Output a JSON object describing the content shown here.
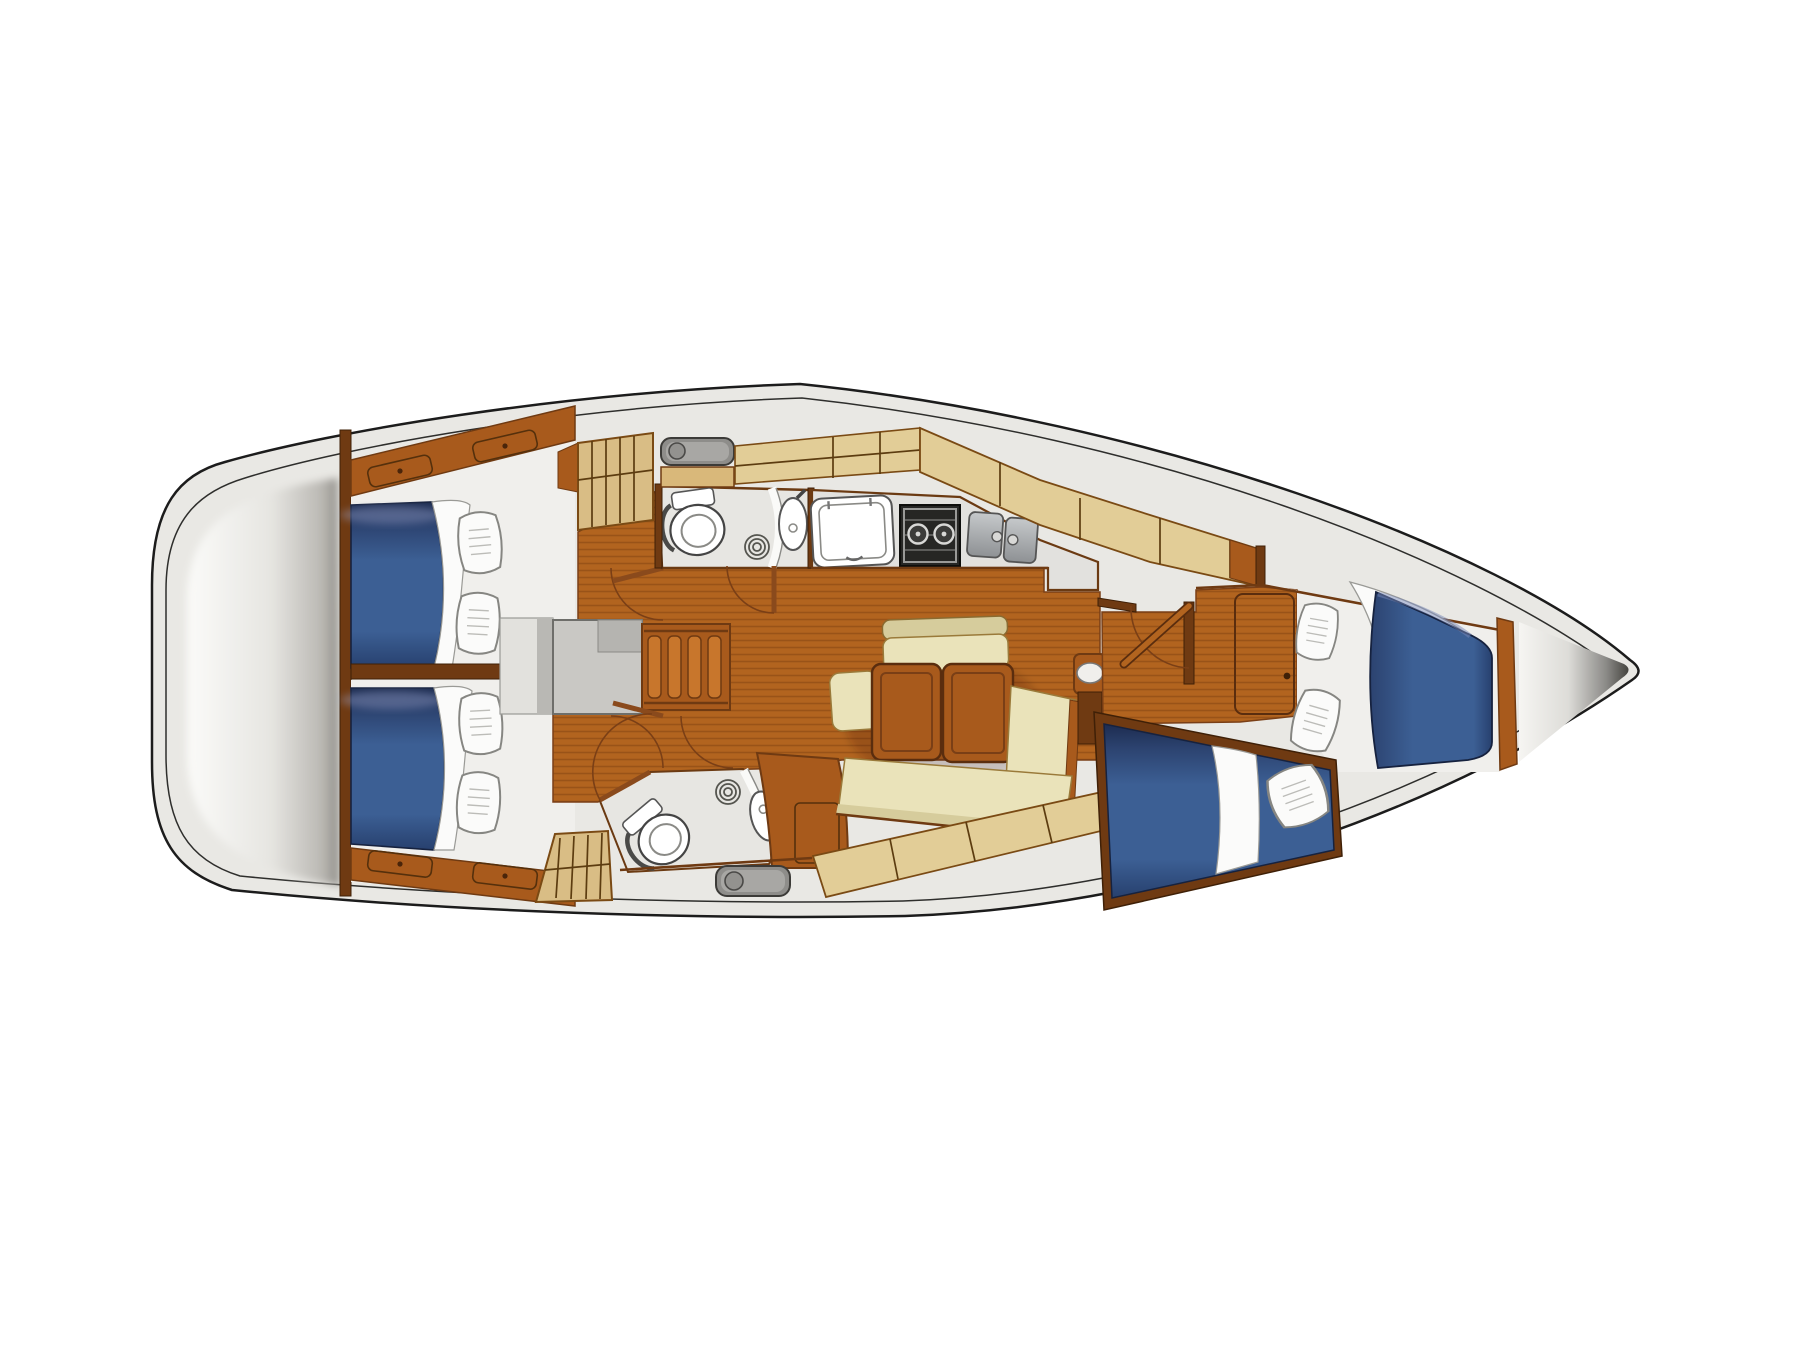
{
  "page": {
    "background": "#ffffff",
    "diagram_type": "sailboat-interior-deck-plan",
    "orientation": "bow-right-stern-left"
  },
  "colors": {
    "page_bg": "#ffffff",
    "outline": "#1c1c1c",
    "hull_fill": "#e9e8e4",
    "stern_light": "#fbfbf9",
    "stern_mid": "#e6e5e1",
    "stern_dark": "#8f8d88",
    "wood_dark": "#6f3a12",
    "wood_mid": "#a85a1c",
    "wood_light": "#c8762c",
    "floor": "#b2641f",
    "locker_tan": "#e2cd97",
    "locker_tan2": "#d9bd85",
    "shelf_wood": "#d9b87a",
    "cushion": "#eae3ba",
    "cushion_dark": "#d6cc9c",
    "mattress": "#3c5f94",
    "mattress_dark": "#27406e",
    "mattress_navy": "#1d2c50",
    "sheet": "#fbfbfa",
    "white_room": "#f0efec",
    "room_gray": "#e7e6e2",
    "fixture": "#ffffff",
    "steel_light": "#c6c9cb",
    "steel_dark": "#8e9194",
    "stove": "#262624",
    "hatch": "#8e8d8a",
    "hatch_inner": "#a8a7a4",
    "engine_gray": "#c9c8c4",
    "anchor_dark": "#45443f",
    "arc_brown": "#7a3f16"
  },
  "parts": [
    "hull",
    "stern-lazarette",
    "aft-cabin-port",
    "aft-cabin-starboard",
    "companionway-steps",
    "engine-compartment",
    "aft-head",
    "forward-head",
    "galley",
    "stove",
    "double-sink",
    "icebox",
    "salon-dinette",
    "folding-table",
    "settee",
    "hanging-locker",
    "deck-hatch",
    "mast-post",
    "forward-cabin",
    "v-berth",
    "offset-berth",
    "anchor-locker",
    "pillow",
    "toilet",
    "washbasin",
    "shower-drain",
    "door-swing"
  ],
  "counts": {
    "cabins": 3,
    "heads": 2,
    "pillows": 7,
    "deck_hatches": 2,
    "companionway_steps": 4,
    "stove_burners": 2,
    "galley_sink_basins": 2
  }
}
